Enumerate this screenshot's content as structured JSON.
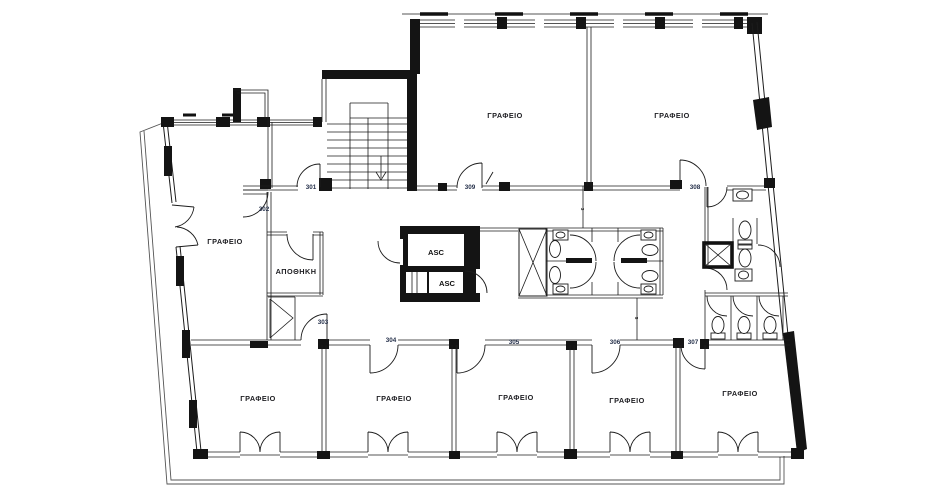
{
  "palette": {
    "ink": "#1c1c1c",
    "wall_fill": "#141414",
    "door_number_ink": "#25304a",
    "background": "#ffffff"
  },
  "rooms": {
    "offices": [
      "ΓΡΑΦΕΙΟ",
      "ΓΡΑΦΕΙΟ",
      "ΓΡΑΦΕΙΟ",
      "ΓΡΑΦΕΙΟ",
      "ΓΡΑΦΕΙΟ",
      "ΓΡΑΦΕΙΟ",
      "ΓΡΑΦΕΙΟ",
      "ΓΡΑΦΕΙΟ"
    ],
    "storage": "ΑΠΟΘΗΚΗ",
    "elevators": [
      "ASC",
      "ASC"
    ]
  },
  "door_numbers": [
    "301",
    "302",
    "303",
    "304",
    "305",
    "306",
    "307",
    "308",
    "309"
  ],
  "annotations": {
    "partition_marks": [
      "3",
      "5"
    ]
  }
}
